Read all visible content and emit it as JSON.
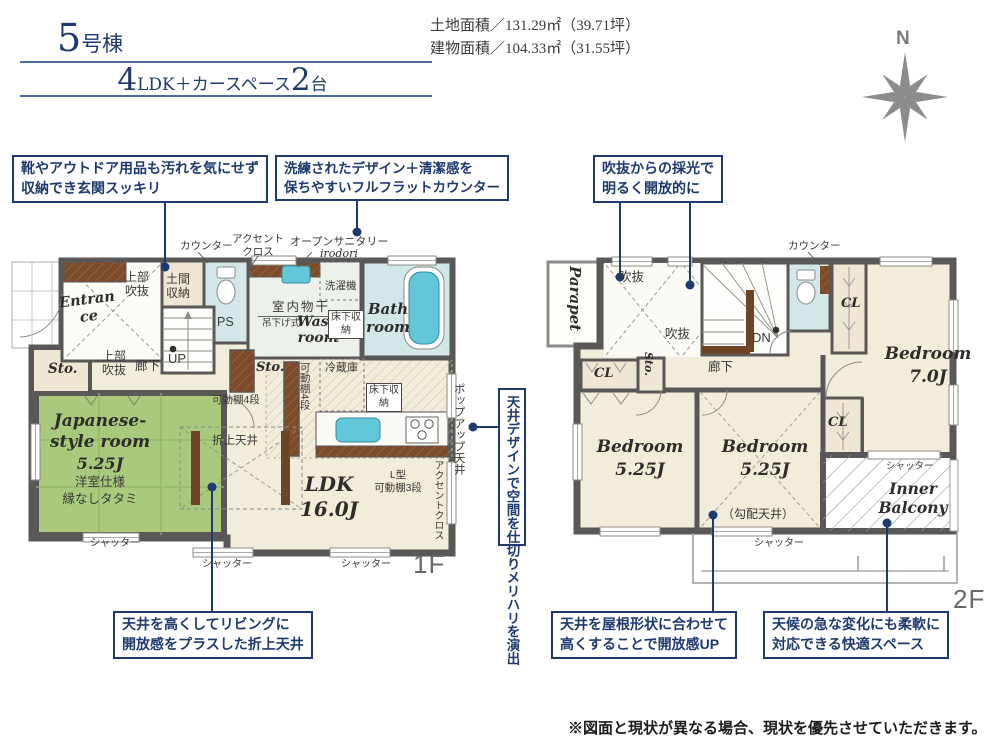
{
  "header": {
    "unit_number": "5",
    "unit_suffix": "号棟",
    "plan_big1": "4",
    "plan_text1": "LDK＋カースペース",
    "plan_big2": "2",
    "plan_text2": "台",
    "land_area": "土地面積／131.29㎡（39.71坪）",
    "building_area": "建物面積／104.33㎡（31.55坪）"
  },
  "compass": {
    "north": "N"
  },
  "callouts": {
    "entrance_storage": {
      "line1": "靴やアウトドア用品も汚れを気にせず",
      "line2": "収納でき玄関スッキリ"
    },
    "flat_counter": {
      "line1": "洗練されたデザイン＋清潔感を",
      "line2": "保ちやすいフルフラットカウンター"
    },
    "void_light": {
      "line1": "吹抜からの採光で",
      "line2": "明るく開放的に"
    },
    "ceiling_zoning": "天井デザインで空間を仕切りメリハリを演出",
    "coffered_ceiling": {
      "line1": "天井を高くしてリビングに",
      "line2": "開放感をプラスした折上天井"
    },
    "sloped_ceiling_up": {
      "line1": "天井を屋根形状に合わせて",
      "line2": "高くすることで開放感UP"
    },
    "inner_balcony_note": {
      "line1": "天候の急な変化にも柔軟に",
      "line2": "対応できる快適スペース"
    }
  },
  "floor1": {
    "floor_label": "1F",
    "entrance": "Entrance",
    "upper_void_1": "上部吹抜",
    "upper_void_2": "上部吹抜",
    "doma_storage": "土間収納",
    "counter": "カウンター",
    "accent_cross_1": "アクセントクロス",
    "accent_cross_2": "アクセントクロス",
    "open_sanitary": "オープンサニタリー",
    "open_sanitary_sub": "irodori",
    "washer": "洗濯機",
    "indoor_drying": "室内物干",
    "indoor_drying_sub": "吊下げ式",
    "wash_room": "Wash room",
    "underfloor_1": "床下収納",
    "underfloor_2": "床下収納",
    "bath_room": "Bath room",
    "ps": "PS",
    "up": "UP",
    "hallway": "廊下",
    "sto_1": "Sto.",
    "sto_2": "Sto.",
    "shelf_4_h": "可動棚4段",
    "shelf_4_v": "可動棚4段",
    "fridge": "冷蔵庫",
    "l_shelf_1": "L型",
    "l_shelf_2": "可動棚3段",
    "ldk_name": "LDK",
    "ldk_size": "16.0J",
    "coffered": "折上天井",
    "jroom_name_1": "Japanese-",
    "jroom_name_2": "style room",
    "jroom_size": "5.25J",
    "jroom_sub_1": "洋室仕様",
    "jroom_sub_2": "縁なしタタミ",
    "popup_ceiling": "ポップアップ天井",
    "shutter_1": "シャッター",
    "shutter_2": "シャッター",
    "shutter_3": "シャッター"
  },
  "floor2": {
    "floor_label": "2F",
    "parapet": "Parapet",
    "void_1": "吹抜",
    "void_2": "吹抜",
    "dn": "DN",
    "hallway": "廊下",
    "counter": "カウンター",
    "cl_1": "CL",
    "cl_2": "CL",
    "cl_3": "CL",
    "sto": "Sto.",
    "bedroom_a_name": "Bedroom",
    "bedroom_a_size": "7.0J",
    "bedroom_b_name": "Bedroom",
    "bedroom_b_size": "5.25J",
    "bedroom_c_name": "Bedroom",
    "bedroom_c_size": "5.25J",
    "sloped_note": "（勾配天井）",
    "inner_balcony": "Inner Balcony",
    "shutter_1": "シャッター",
    "shutter_2": "シャッター"
  },
  "footer": {
    "disclaimer": "※図面と現状が異なる場合、現状を優先させていただきます。"
  },
  "colors": {
    "navy": "#1e3a6e",
    "wall": "#5a5757",
    "floor": "#f2ecda",
    "tatami": "#a9ca7d",
    "wet_area": "#d3e7e8",
    "tub": "#63c7da",
    "wood": "#7b4b2a"
  }
}
